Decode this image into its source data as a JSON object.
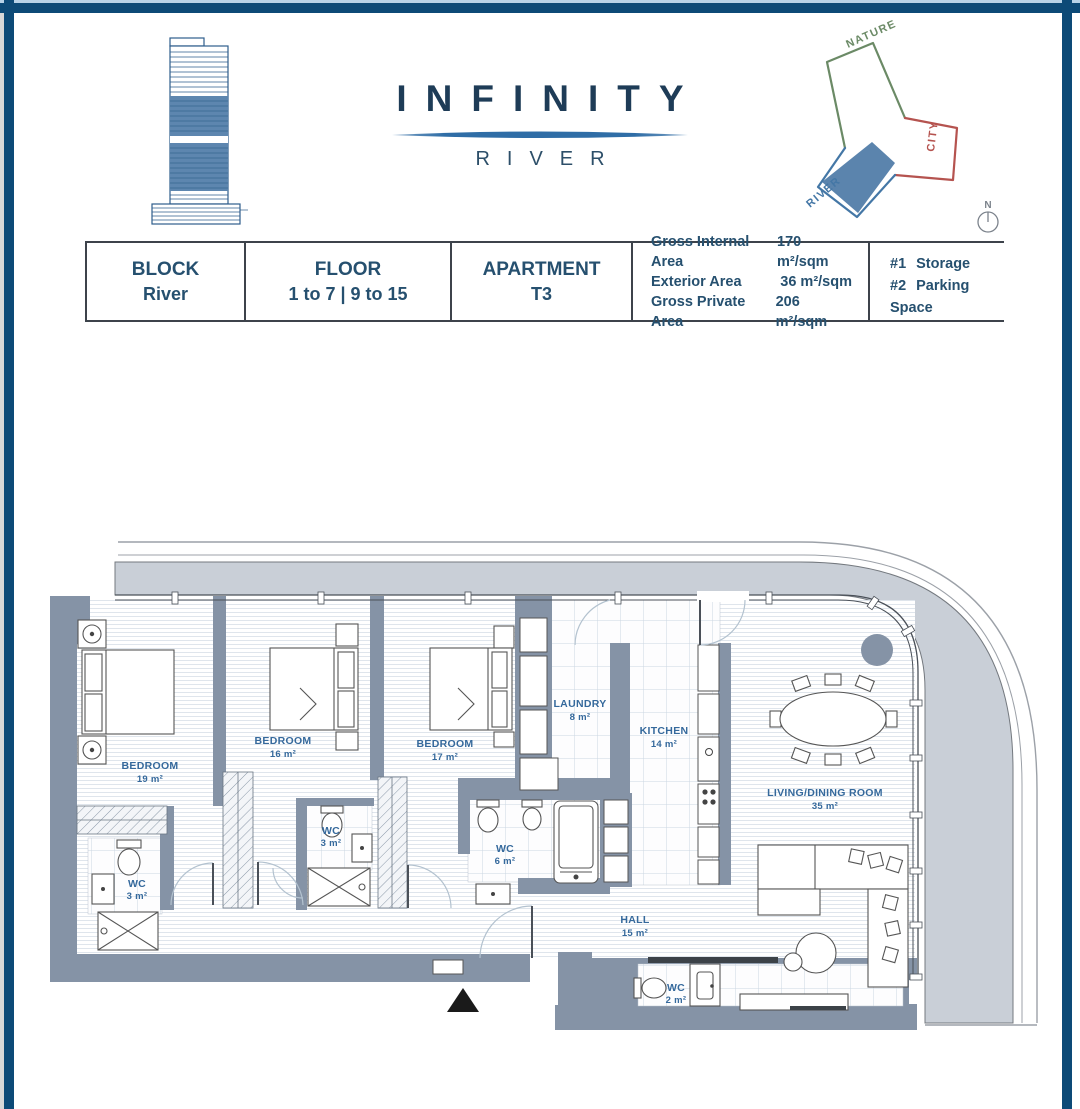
{
  "brand": {
    "title": "INFINITY",
    "subtitle": "RIVER"
  },
  "site_diagram": {
    "nature_label": "NATURE",
    "city_label": "CITY",
    "river_label": "RIVER",
    "compass_n": "N"
  },
  "info_table": {
    "cells": [
      {
        "label": "BLOCK",
        "value": "River"
      },
      {
        "label": "FLOOR",
        "value": "1 to 7 | 9 to 15"
      },
      {
        "label": "APARTMENT",
        "value": "T3"
      }
    ],
    "areas": [
      {
        "label": "Gross Internal Area",
        "value": "170 m²/sqm"
      },
      {
        "label": "Exterior Area",
        "value": "36 m²/sqm"
      },
      {
        "label": "Gross Private Area",
        "value": "206 m²/sqm"
      }
    ],
    "extras": [
      {
        "num": "#1",
        "label": "Storage"
      },
      {
        "num": "#2",
        "label": "Parking Space"
      }
    ]
  },
  "floor_plan": {
    "rooms": [
      {
        "name": "BEDROOM",
        "area": "19 m²"
      },
      {
        "name": "BEDROOM",
        "area": "16 m²"
      },
      {
        "name": "BEDROOM",
        "area": "17 m²"
      },
      {
        "name": "LAUNDRY",
        "area": "8 m²"
      },
      {
        "name": "KITCHEN",
        "area": "14 m²"
      },
      {
        "name": "LIVING/DINING ROOM",
        "area": "35 m²"
      },
      {
        "name": "WC",
        "area": "3 m²"
      },
      {
        "name": "WC",
        "area": "3 m²"
      },
      {
        "name": "WC",
        "area": "6 m²"
      },
      {
        "name": "HALL",
        "area": "15 m²"
      },
      {
        "name": "WC",
        "area": "2 m²"
      }
    ]
  },
  "colors": {
    "border_navy": "#0d4a77",
    "brand_navy": "#1e3c57",
    "swoosh_blue": "#2f6da6",
    "wall_slate": "#8593a6",
    "terrace_gray": "#c9cfd7",
    "room_label_blue": "#35699c",
    "site_green": "#6b8a66",
    "site_red": "#b5534f",
    "site_blue": "#4477a6"
  }
}
